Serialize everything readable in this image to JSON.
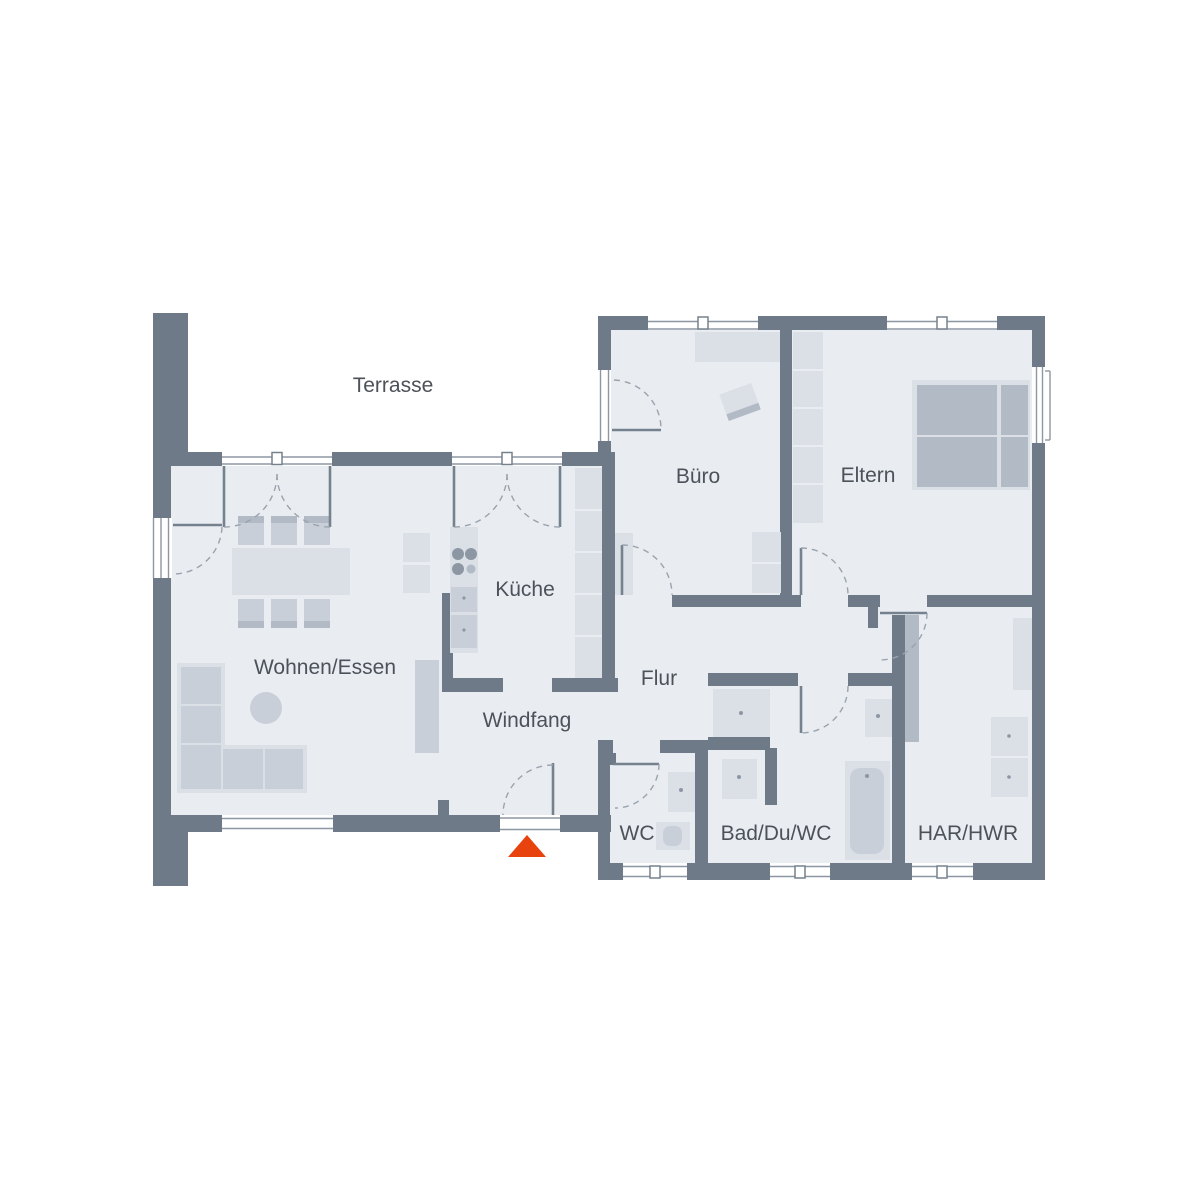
{
  "plan": {
    "type": "floor-plan",
    "style": "architectural top-down plan, single storey bungalow",
    "rooms": [
      {
        "name": "terrasse",
        "label": "Terrasse"
      },
      {
        "name": "wohnen-essen",
        "label": "Wohnen/Essen"
      },
      {
        "name": "kueche",
        "label": "Küche"
      },
      {
        "name": "windfang",
        "label": "Windfang"
      },
      {
        "name": "flur",
        "label": "Flur"
      },
      {
        "name": "buero",
        "label": "Büro"
      },
      {
        "name": "eltern",
        "label": "Eltern"
      },
      {
        "name": "wc",
        "label": "WC"
      },
      {
        "name": "bad-du-wc",
        "label": "Bad/Du/WC"
      },
      {
        "name": "har-hwr",
        "label": "HAR/HWR"
      }
    ],
    "colors": {
      "background": "#ffffff",
      "wall": "#6e7a88",
      "room": "#e9edf2",
      "furniture_light": "#dbe0e7",
      "furniture_mid": "#c9cfd9",
      "furniture_dark": "#b2bac6",
      "window_frame": "#8d97a3",
      "door_leaf": "#76818e",
      "swing_arc": "#9aa3ad",
      "label_text": "#4c525a",
      "entrance_marker": "#e8430f"
    },
    "entrance": {
      "name": "main-entrance",
      "marker": "red triangle pointing at entrance door"
    }
  }
}
